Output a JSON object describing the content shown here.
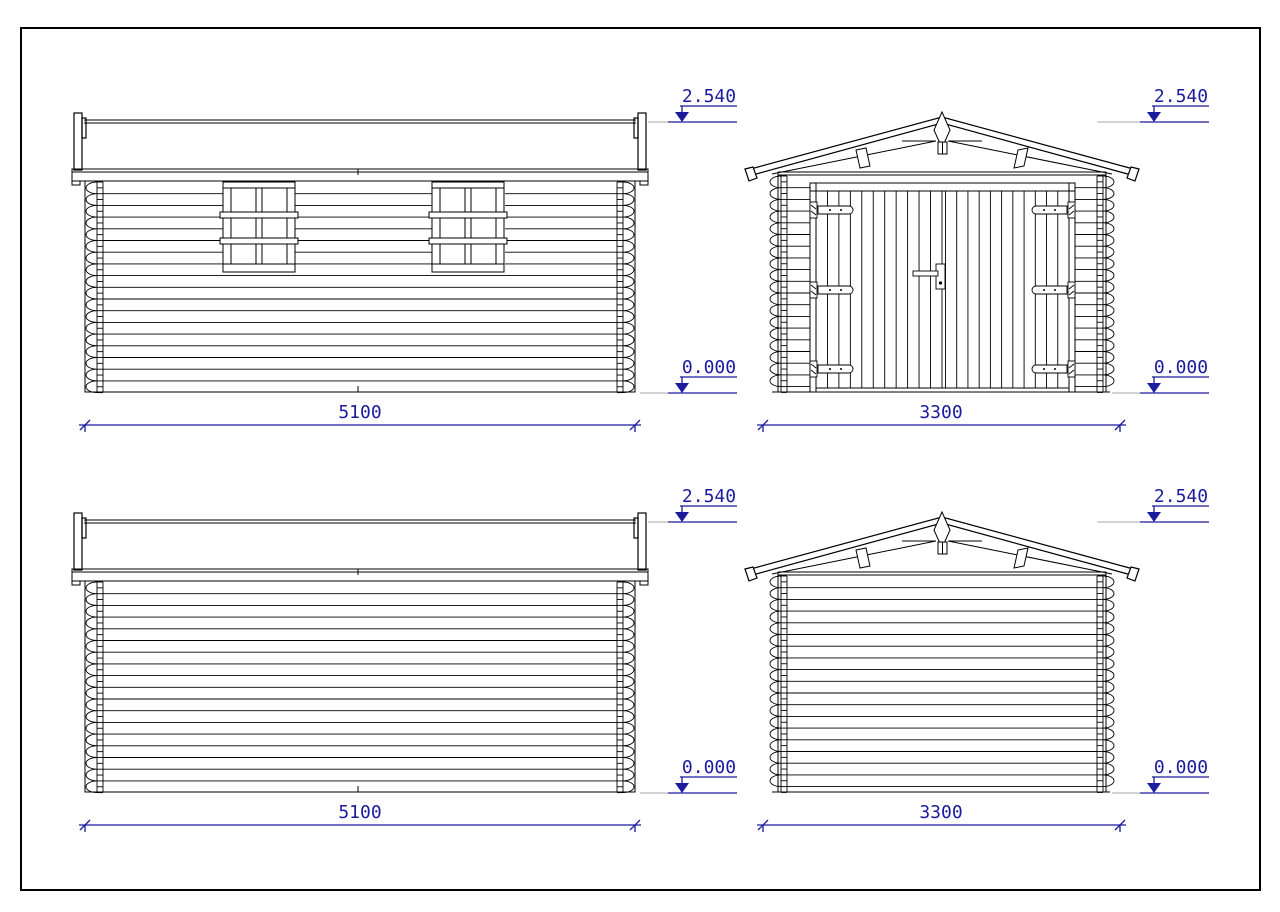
{
  "drawing": {
    "type": "technical-elevation-drawing",
    "subject": "log garage elevations",
    "colors": {
      "line": "#000000",
      "dimension": "#1b1b9e",
      "reference": "#a9a9a9",
      "paper": "#ffffff"
    },
    "views": {
      "side_top": {
        "name": "side elevation with windows",
        "width_label": "5100",
        "level_upper": "2.540",
        "level_lower": "0.000"
      },
      "front": {
        "name": "front elevation with garage door",
        "width_label": "3300",
        "level_upper": "2.540",
        "level_lower": "0.000"
      },
      "side_bottom": {
        "name": "side elevation plain",
        "width_label": "5100",
        "level_upper": "2.540",
        "level_lower": "0.000"
      },
      "rear": {
        "name": "rear elevation",
        "width_label": "3300",
        "level_upper": "2.540",
        "level_lower": "0.000"
      }
    }
  }
}
